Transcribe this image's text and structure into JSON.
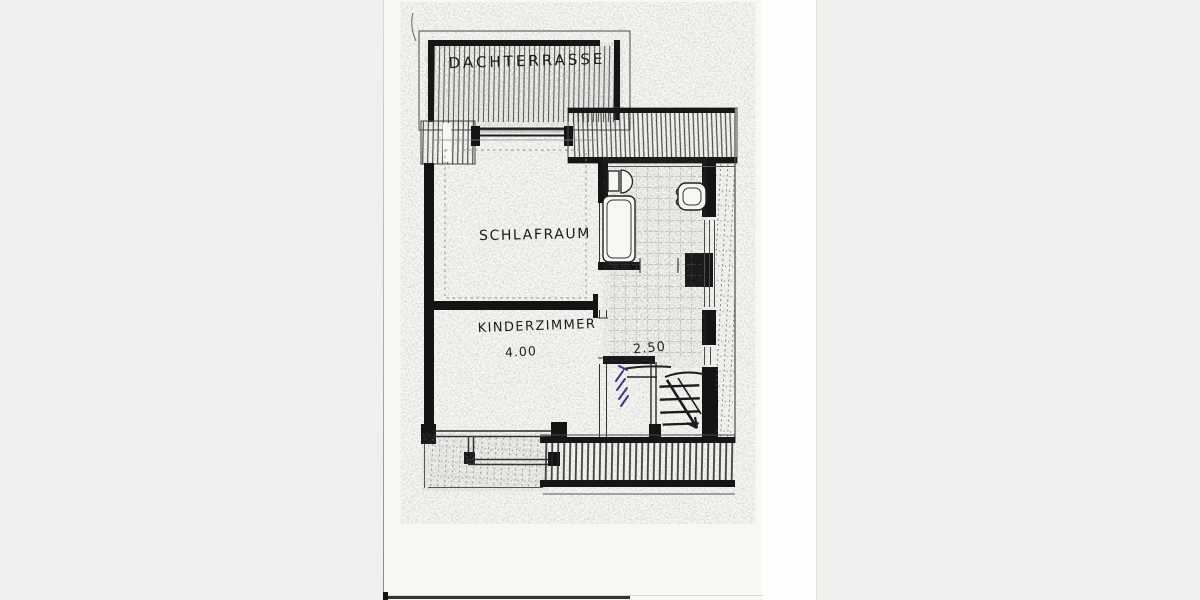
{
  "scene": {
    "backdrop_color": "#f0efed",
    "paper_color": "#f8f7f4",
    "scan_margin_color": "#fdfdfc"
  },
  "plan": {
    "ink_color": "#1a1a1a",
    "pencil_color": "#444444",
    "blue_pen_color": "#3d3794",
    "rooms": [
      {
        "name": "roof-terrace",
        "label": "DACHTERRASSE"
      },
      {
        "name": "bedroom",
        "label": "SCHLAFRAUM"
      },
      {
        "name": "childrens-room",
        "label": "KINDERZIMMER"
      }
    ],
    "dimensions": [
      {
        "value": "4.00",
        "location": "kinderzimmer"
      },
      {
        "value": "2.50",
        "location": "stair-landing"
      }
    ],
    "features": [
      "bathtub-icon",
      "washbasin-icon",
      "toilet-icon",
      "stairs-icon",
      "stairs-arrow-icon",
      "balcony-railing",
      "blue-pen-annotation"
    ]
  }
}
